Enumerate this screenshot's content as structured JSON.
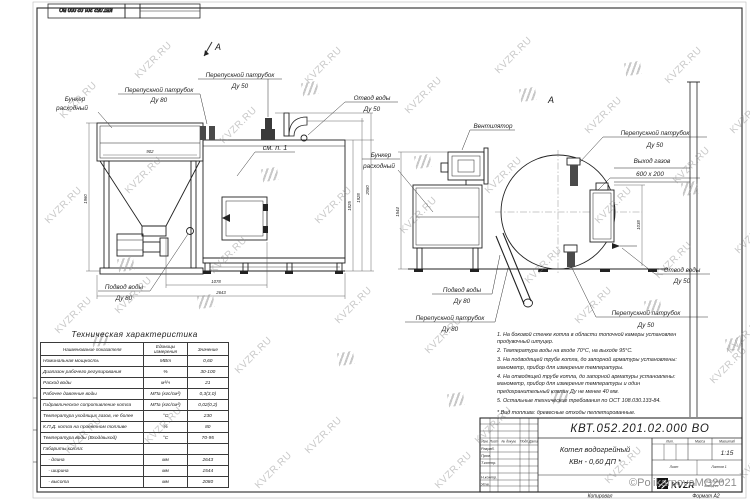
{
  "sheet": {
    "watermark_text": "KVZR.RU",
    "copyright": "©PolikarpovaMG2021",
    "top_stamp_number": "КВТ.052.201.02.000  ВО",
    "footer_left": "Копировал",
    "footer_right": "Формат А2"
  },
  "front_view": {
    "section_mark": "А",
    "see_note": "см. п. 1",
    "labels": {
      "bunker": [
        "Бункер",
        "расходный"
      ],
      "bypass_80": [
        "Перепускной патрубок",
        "Ду 80"
      ],
      "bypass_50": [
        "Перепускной патрубок",
        "Ду 50"
      ],
      "water_outlet_50": [
        "Отвод воды",
        "Ду 50"
      ],
      "water_inlet_80": [
        "Подвод воды",
        "Ду 80"
      ]
    },
    "dims": {
      "hopper_width": "902",
      "hopper_height": "1960",
      "body_width": "1078",
      "total_length": "2643",
      "h1": "1825",
      "h2": "1928",
      "h3": "2080"
    }
  },
  "side_view": {
    "view_mark": "А",
    "labels": {
      "fan": "Вентилятор",
      "bunker": [
        "Бункер",
        "расходный"
      ],
      "bypass_50_top": [
        "Перепускной патрубок",
        "Ду 50"
      ],
      "gas_outlet": [
        "Выход газов",
        "600 х 200"
      ],
      "water_inlet_80": [
        "Подвод воды",
        "Ду 80"
      ],
      "bypass_80": [
        "Перепускной патрубок",
        "Ду 80"
      ],
      "water_outlet_50": [
        "Отвод воды",
        "Ду 50"
      ],
      "bypass_50_bottom": [
        "Перепускной патрубок",
        "Ду 50"
      ]
    },
    "dims": {
      "width": "1544",
      "gas_duct_height": "1038"
    }
  },
  "spec_table": {
    "title": "Техническая характеристика",
    "headers": [
      "Наименование показателя",
      "Единицы измерения",
      "Значение"
    ],
    "rows": [
      [
        "Номинальная мощность",
        "МВт",
        "0,60"
      ],
      [
        "Диапазон рабочего регулирования",
        "%",
        "30-100"
      ],
      [
        "Расход воды",
        "м³/ч",
        "21"
      ],
      [
        "Рабочее давление воды",
        "МПа (кгс/см²)",
        "0,3(3,0)"
      ],
      [
        "Гидравлическое сопротивление котла",
        "МПа (кгс/см²)",
        "0,02(0,2)"
      ],
      [
        "Температура уходящих газов, не более",
        "°С",
        "230"
      ],
      [
        "К.П.Д. котла на проектном топливе",
        "%",
        "80"
      ],
      [
        "Температура воды (Вход/выход)",
        "°С",
        "70-95"
      ],
      [
        "Габариты котла:",
        "",
        ""
      ],
      [
        "    - длина",
        "мм",
        "2643"
      ],
      [
        "    - ширина",
        "мм",
        "1544"
      ],
      [
        "    - высота",
        "мм",
        "2080"
      ]
    ]
  },
  "notes": {
    "items": [
      "1. На боковой стенке котла в области топочной камеры установлен продувочный штуцер.",
      "2. Температура воды на входе  70°С, на выходе  95°С.",
      "3. На подводящей трубе котла, до запорной арматуры установлены: манометр, прибор для измерения температуры.",
      "4. На отводящей трубе котла, до запорной арматуры установлены: манометр, прибор для измерения температуры и один предохранительный клапан Ду не менее 40 мм.",
      "5. Остальные технические требования по ОСТ 108.030.133-84."
    ],
    "fuel_note": "* Вид топлива:  древесные отходы пеллетированные."
  },
  "title_block": {
    "doc_number": "КВТ.052.201.02.000  ВО",
    "product_name": [
      "Котел водогрейный",
      "КВн - 0,60   ДП *"
    ],
    "scale_value": "1:15",
    "col_headers": [
      "Изм.",
      "Лист",
      "№ докум.",
      "Подп.",
      "Дата"
    ],
    "row_labels": [
      "Разраб.",
      "Пров.",
      "Т.контр.",
      "Н.контр.",
      "Утв."
    ],
    "lit_label": "Лит.",
    "mass_label": "Масса",
    "scale_label": "Масштаб",
    "sheet_label": "Лист",
    "sheets_label": "Листов 1",
    "logo_text": "KVZR",
    "logo_sub": [
      "КОТЕЛЬНЫЙ",
      "ЗАВОД.РУ"
    ]
  }
}
